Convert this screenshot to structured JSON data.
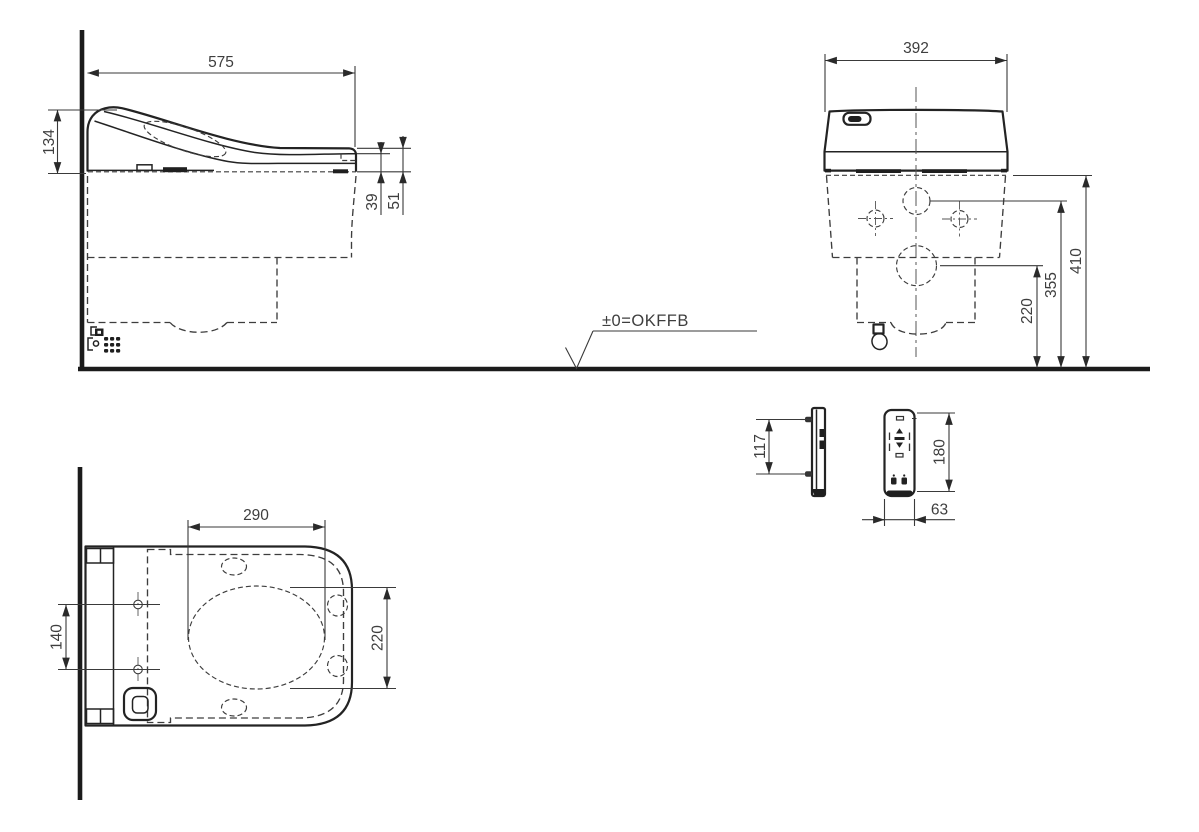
{
  "drawing": {
    "datum": {
      "label": "±0=OKFFB"
    },
    "side_view": {
      "overall_depth": "575",
      "front_height": "134",
      "rear_offset_inner": "39",
      "rear_offset_outer": "51"
    },
    "front_view": {
      "overall_width": "392",
      "supply_height": "220",
      "fixing_height": "355",
      "underside_height": "410"
    },
    "remote": {
      "fixing_pitch": "117",
      "height": "180",
      "width": "63"
    },
    "top_view": {
      "bowl_opening_width": "290",
      "bowl_opening_depth": "220",
      "fixing_pitch": "140"
    },
    "colors": {
      "line": "#232323",
      "dash": "#3d3d3d",
      "text": "#3e3e3e"
    }
  }
}
